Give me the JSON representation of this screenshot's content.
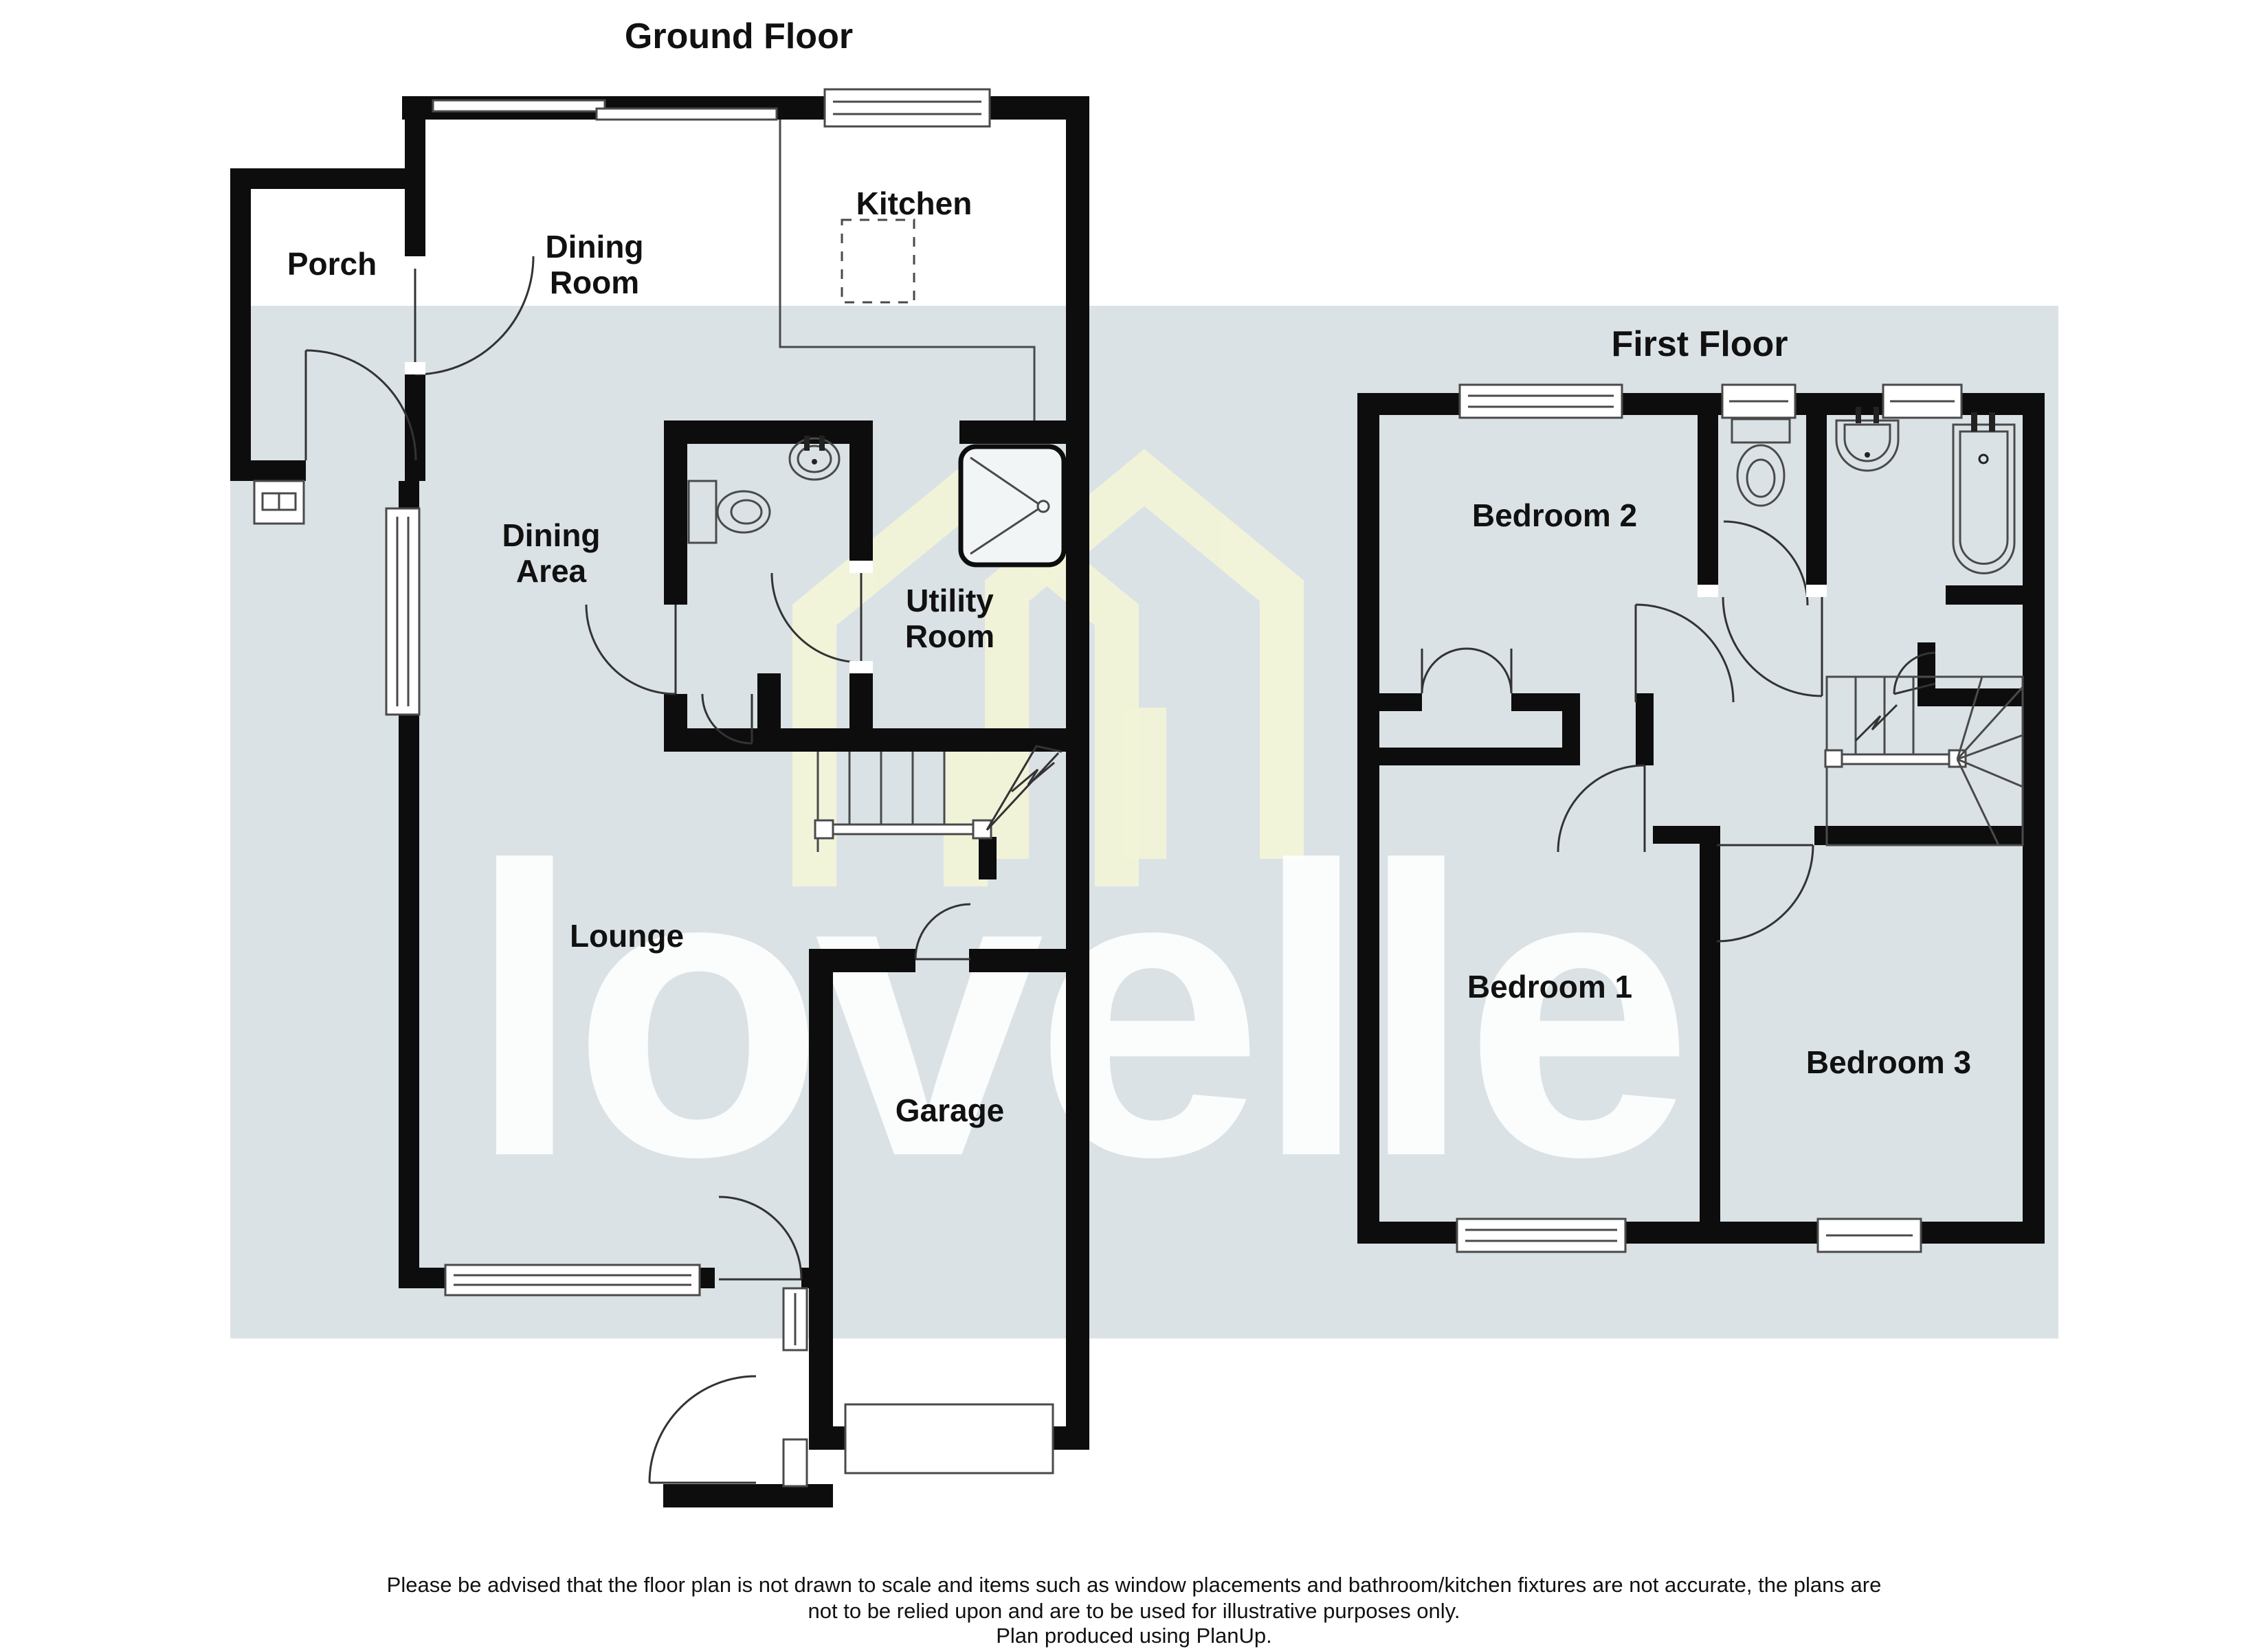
{
  "titles": {
    "ground_floor": "Ground Floor",
    "first_floor": "First Floor"
  },
  "watermark": {
    "text": "lovelle",
    "house_icon": "double-gable-house-icon"
  },
  "colors": {
    "background": "#ffffff",
    "band": "#dbe2e6",
    "walls": "#0d0d0d",
    "watermark_text": "rgba(255,255,255,0.88)",
    "watermark_house": "rgba(246,247,215,0.95)",
    "label_text": "#111111"
  },
  "ground_floor": {
    "rooms": {
      "porch": {
        "label": "Porch"
      },
      "dining_room": {
        "line1": "Dining",
        "line2": "Room"
      },
      "kitchen": {
        "label": "Kitchen"
      },
      "dining_area": {
        "line1": "Dining",
        "line2": "Area"
      },
      "utility_room": {
        "line1": "Utility",
        "line2": "Room"
      },
      "lounge": {
        "label": "Lounge"
      },
      "garage": {
        "label": "Garage"
      }
    },
    "fixtures": [
      "toilet",
      "basin",
      "shower",
      "stairs-up-arrow"
    ]
  },
  "first_floor": {
    "rooms": {
      "bedroom_2": {
        "label": "Bedroom 2"
      },
      "bedroom_1": {
        "label": "Bedroom 1"
      },
      "bedroom_3": {
        "label": "Bedroom 3"
      }
    },
    "fixtures": [
      "toilet",
      "basin",
      "bath",
      "winder-stairs"
    ]
  },
  "footer": {
    "line1": "Please be advised that the floor plan is not drawn to scale and items such as window placements and bathroom/kitchen fixtures are not accurate, the plans are",
    "line2": "not to be relied upon and are to be used for illustrative purposes only.",
    "line3": "Plan produced using PlanUp."
  }
}
